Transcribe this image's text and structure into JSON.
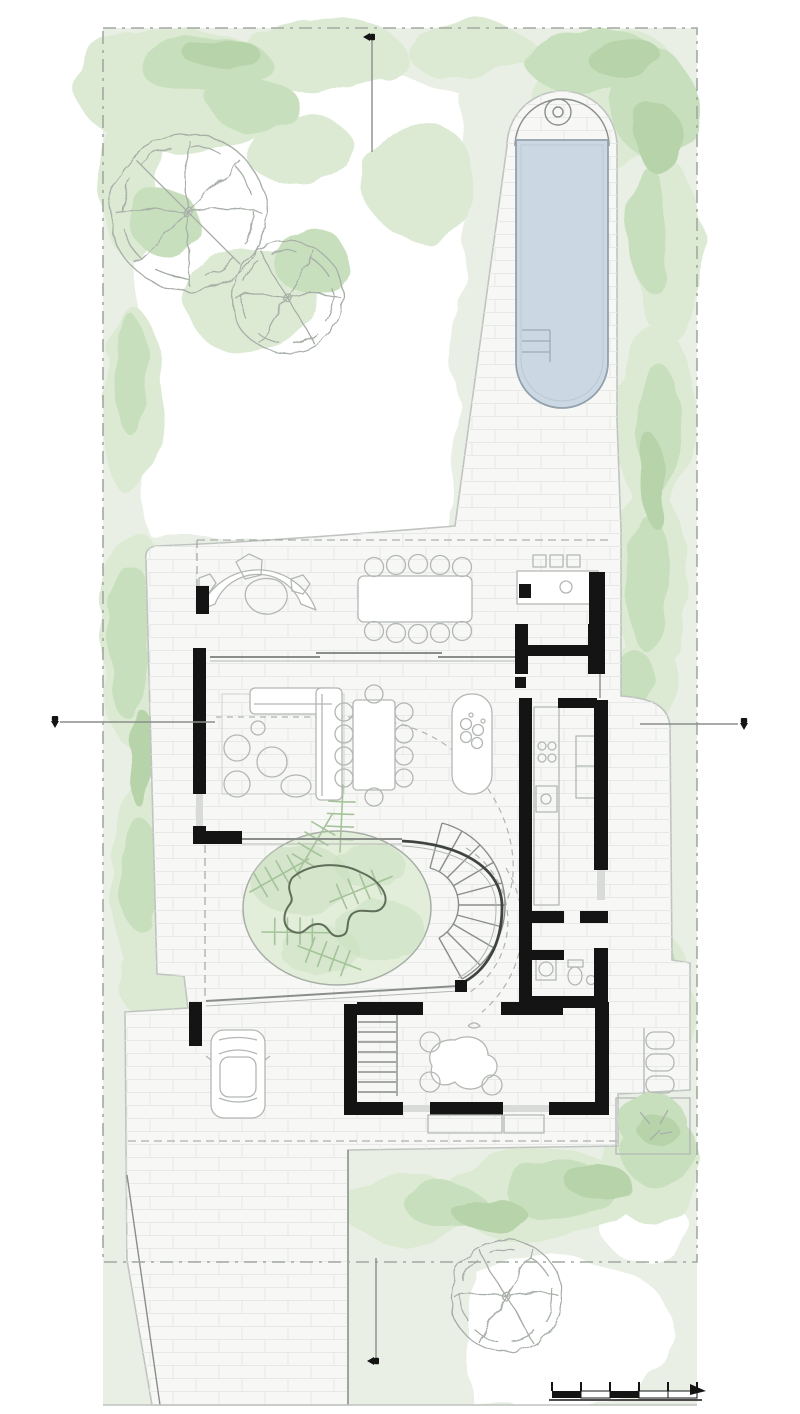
{
  "plan": {
    "kind": "architectural ground-floor site plan",
    "features": [
      "swimming-pool",
      "pool-deck",
      "garden-lawn",
      "trees",
      "covered-terrace",
      "outdoor-dining-table",
      "outdoor-kitchen",
      "fire-pit-bench",
      "living-room",
      "dining-table",
      "bar-planter",
      "galley-kitchen",
      "pantry",
      "wc-laundry",
      "oval-courtyard-garden",
      "curved-stair",
      "straight-stair",
      "study-room",
      "carport",
      "car",
      "driveway",
      "plant-bed",
      "section-markers",
      "scale-bar"
    ],
    "trees": 3,
    "section_markers": [
      "top",
      "bottom",
      "left",
      "right"
    ],
    "scale_bar_segments": 5,
    "furniture_counts": {
      "outdoor_dining_chairs": 10,
      "indoor_dining_chairs": 10,
      "bar_stools": 3,
      "study_chairs": 3,
      "armchairs": 2,
      "pool_ladder_steps": 3
    }
  },
  "colors": {
    "background": "#ffffff",
    "site_green": "#e9efe5",
    "vegetation_light": "#dcead3",
    "vegetation_mid": "#c8dfbd",
    "vegetation_dark": "#b7d3aa",
    "lawn": "#ffffff",
    "paving": "#f7f8f6",
    "paving_grid": "#e7e9e6",
    "paving_edge": "#c0c4c0",
    "pool_water": "#cbd8e3",
    "pool_edge": "#93a1ad",
    "wall": "#141414",
    "furniture": "#b3b7b3",
    "detail": "#8a8e8a",
    "boundary": "#a2a9a1",
    "tree": "#a7aea7",
    "courtyard_bed": "#e2edda",
    "fern": "#a5c399",
    "sculpture": "#5f6e5a"
  }
}
